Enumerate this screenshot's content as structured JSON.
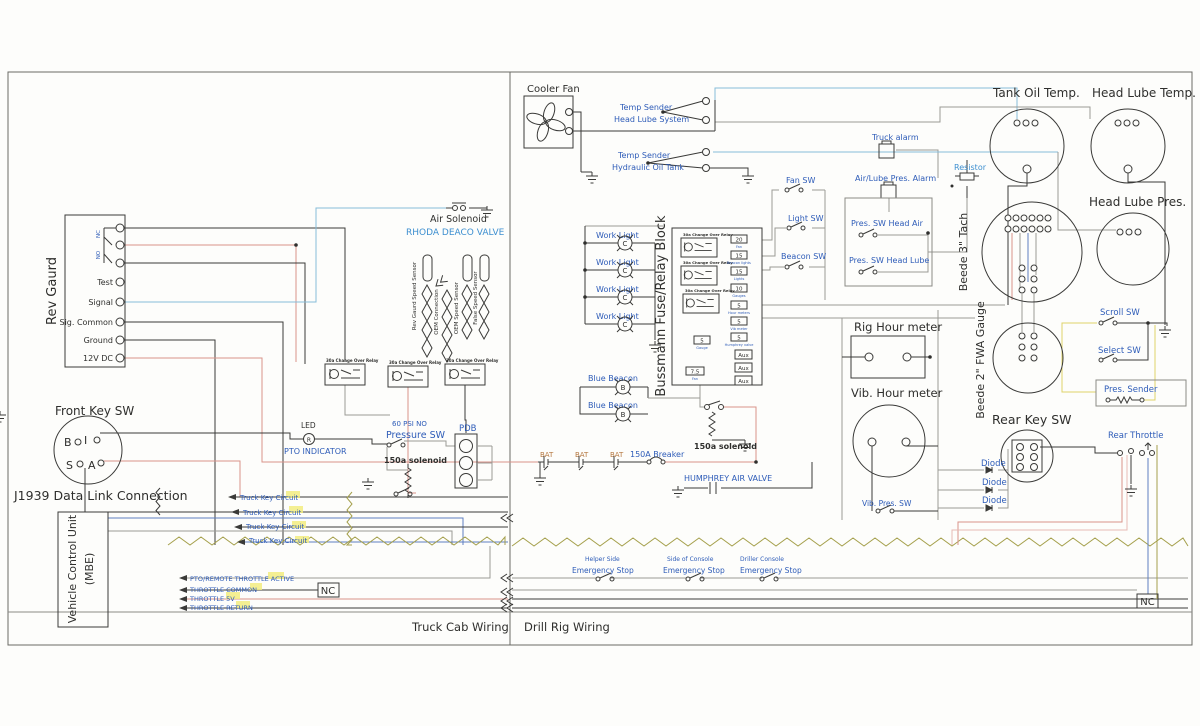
{
  "colors": {
    "label_blue": "#2e5cb8",
    "label_cyan": "#3d8fd0",
    "ink": "#2f2f2d",
    "wire_red": "#d9938a",
    "wire_blue": "#5f7fc0",
    "wire_cyan": "#86bdd9",
    "wire_yellow": "#ded268",
    "wire_olive": "#a5a04c",
    "wire_gray": "#9a9a96",
    "highlight": "#f2ec7f"
  },
  "frame": {
    "truck_cab": "Truck Cab Wiring",
    "drill_rig": "Drill Rig Wiring"
  },
  "rev_guard": {
    "title": "Rev Gaurd",
    "nc": "NC",
    "no": "NO",
    "t1": "Test",
    "t2": "Signal",
    "t3": "Sig. Common",
    "t4": "Ground",
    "t5": "12V DC"
  },
  "front_key": {
    "title": "Front Key SW",
    "b": "B",
    "i": "I",
    "s": "S",
    "a": "A"
  },
  "j1939": {
    "label": "J1939 Data Link Connection"
  },
  "vcu": {
    "line1": "Vehicle Control Unit",
    "line2": "(MBE)"
  },
  "truck_key": {
    "label": "Truck Key Circuit"
  },
  "throttle": {
    "l1": "PTO/REMOTE THROTTLE ACTIVE",
    "l2": "THROTTLE COMMON",
    "l3": "THROTTLE 5V",
    "l4": "THROTTLE RETURN"
  },
  "nc_box": {
    "label": "NC"
  },
  "air_solenoid": {
    "title": "Air Solenoid",
    "subtitle": "RHODA DEACO VALVE"
  },
  "sensors": {
    "s1": "Rev Gaurd Speed Sensor",
    "s2": "OEM Connection",
    "s3": "OEM Speed Sensor",
    "s4": "False Speed Sensor"
  },
  "relay": {
    "label": "30a Change Over Relay"
  },
  "led": {
    "title": "LED",
    "symbol": "R",
    "subtitle": "PTO INDICATOR"
  },
  "pressure_sw": {
    "rating": "60 PSI NO",
    "label": "Pressure SW"
  },
  "solenoid150a": {
    "label": "150a solenoid"
  },
  "pdb": {
    "label": "PDB"
  },
  "cooler_fan": {
    "label": "Cooler Fan"
  },
  "temp1": {
    "line1": "Temp Sender",
    "line2": "Head Lube System"
  },
  "temp2": {
    "line1": "Temp Sender",
    "line2": "Hydraulic Oil Tank"
  },
  "work_light": {
    "label": "Work Light",
    "symbol": "C"
  },
  "beacon": {
    "label": "Blue Beacon",
    "symbol": "B"
  },
  "fuse_block": {
    "title": "Bussmann Fuse/Relay Block",
    "aux": "Aux",
    "fuses": [
      {
        "value": "20",
        "label": "Fan"
      },
      {
        "value": "15",
        "label": "Beacon lights"
      },
      {
        "value": "15",
        "label": "Lights"
      },
      {
        "value": "10",
        "label": "Gauges"
      },
      {
        "value": "5",
        "label": "Hour meters"
      },
      {
        "value": "5",
        "label": "Vib meter"
      },
      {
        "value": "5",
        "label": "Humphrey valve"
      }
    ],
    "f5": {
      "value": "5",
      "label": "Gauge"
    },
    "f75": {
      "value": "7.5",
      "label": "Fan"
    }
  },
  "sw": {
    "fan": "Fan SW",
    "light": "Light SW",
    "beacon": "Beacon SW"
  },
  "alarm": {
    "truck": "Truck alarm",
    "air_lube": "Air/Lube Pres. Alarm"
  },
  "pres_sw": {
    "air": "Pres. SW Head Air",
    "lube": "Pres. SW Head Lube"
  },
  "resistor": {
    "label": "Resistor"
  },
  "gauge": {
    "tank": "Tank Oil Temp.",
    "hlt": "Head Lube Temp.",
    "hlp": "Head Lube Pres.",
    "tach": "Beede 3\" Tach",
    "fwa": "Beede 2\" FWA Gauge"
  },
  "meter": {
    "rig": "Rig Hour meter",
    "vib": "Vib. Hour meter",
    "vib_sw": "Vib. Pres. SW"
  },
  "rear_key": {
    "title": "Rear Key SW"
  },
  "diode": {
    "label": "Diode"
  },
  "rear_throttle": {
    "label": "Rear Throttle"
  },
  "scroll_sw": {
    "label": "Scroll SW"
  },
  "select_sw": {
    "label": "Select SW"
  },
  "pres_sender": {
    "label": "Pres. Sender"
  },
  "bat": {
    "label": "BAT"
  },
  "breaker": {
    "label": "150A Breaker"
  },
  "humphrey": {
    "label": "HUMPHREY AIR VALVE"
  },
  "estop": {
    "label": "Emergency Stop",
    "loc1": "Helper Side",
    "loc2": "Side of Console",
    "loc3": "Driller Console"
  }
}
